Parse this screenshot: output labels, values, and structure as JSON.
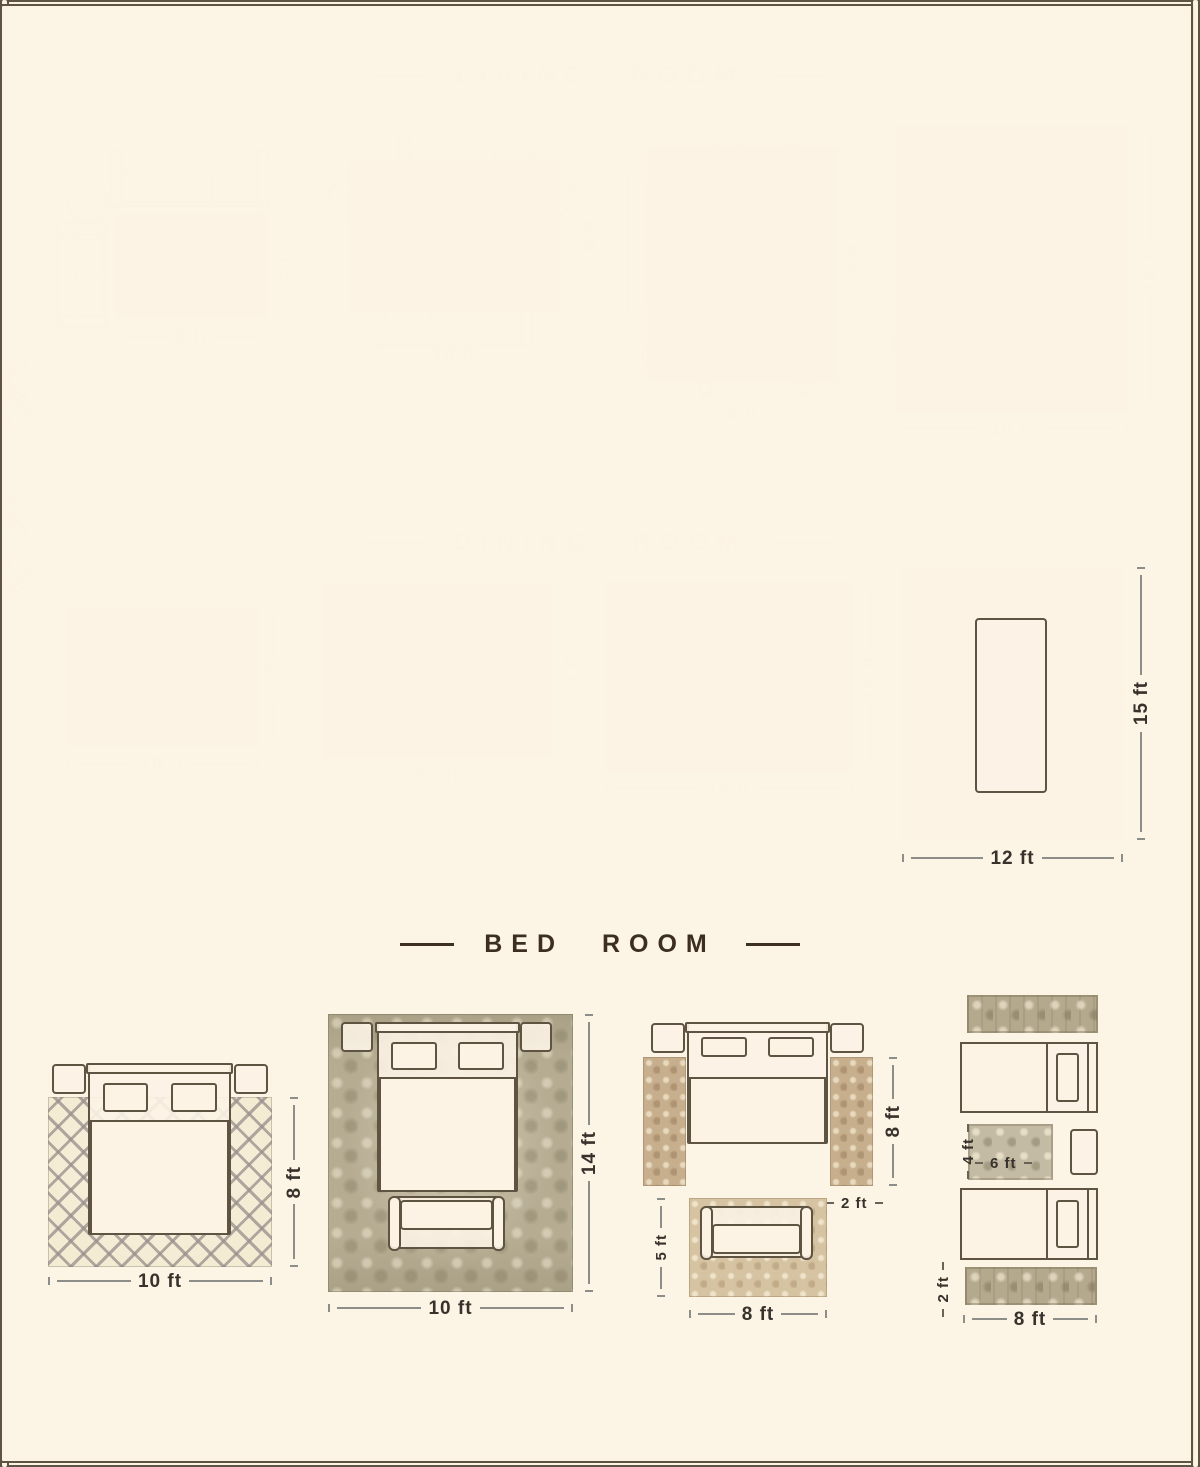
{
  "colors": {
    "furniture_fill": "#faf1e3",
    "furniture_outline": "#5f5341",
    "dimension_text": "#37322b",
    "title": "#3c2f21",
    "background": "#ffffff"
  },
  "sections": [
    {
      "title": "LIVING ROOM",
      "layouts": [
        {
          "labels": {
            "w": "8 ft",
            "h": "5 ft"
          }
        },
        {
          "labels": {
            "w": "10 ft",
            "h": "8 ft"
          }
        },
        {
          "labels": {
            "w": "9 ft",
            "h": "12 ft"
          }
        },
        {
          "labels": {
            "w": "10 ft",
            "h": "14 ft"
          }
        }
      ]
    },
    {
      "title": "DINING ROOM",
      "layouts": [
        {
          "labels": {
            "w": "10 ft",
            "h": "8 ft"
          }
        },
        {
          "labels": {
            "w": "12 ft",
            "h": "9 ft"
          }
        },
        {
          "labels": {
            "w": "14 ft",
            "h": "10 ft"
          }
        },
        {
          "labels": {
            "w": "12 ft",
            "h": "15 ft"
          }
        }
      ]
    },
    {
      "title": "BED ROOM",
      "layouts": [
        {
          "labels": {
            "w": "10 ft",
            "h": "8 ft"
          }
        },
        {
          "labels": {
            "w": "10 ft",
            "h": "14 ft"
          }
        },
        {
          "labels": {
            "runner_h": "8 ft",
            "runner_w": "2 ft",
            "foot_h": "5 ft",
            "foot_w": "8 ft"
          }
        },
        {
          "labels": {
            "mid_h": "4 ft",
            "mid_w": "6 ft",
            "runner_w": "2 ft",
            "bottom_w": "8 ft"
          }
        }
      ]
    }
  ]
}
